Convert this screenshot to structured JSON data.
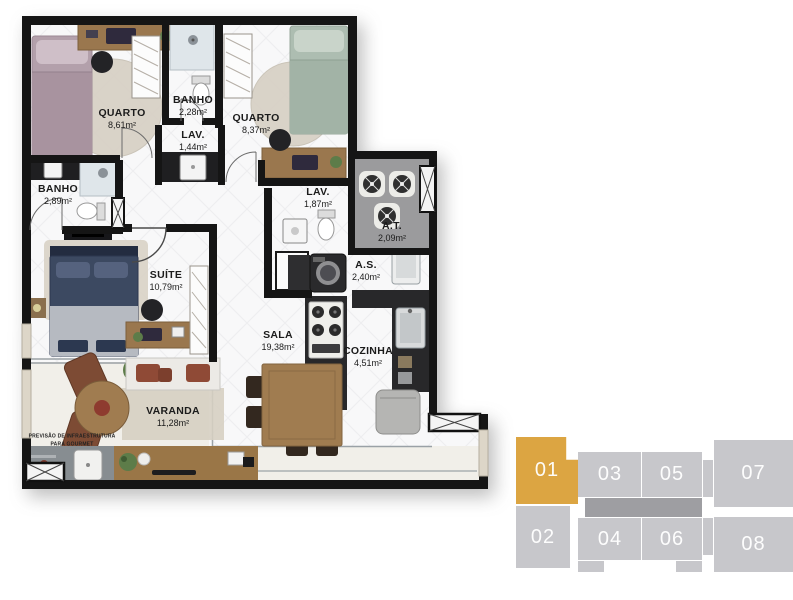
{
  "plan": {
    "rooms": [
      {
        "name": "QUARTO",
        "area": "8,61m²"
      },
      {
        "name": "BANHO",
        "area": "2,28m²"
      },
      {
        "name": "LAV.",
        "area": "1,44m²"
      },
      {
        "name": "QUARTO",
        "area": "8,37m²"
      },
      {
        "name": "BANHO",
        "area": "2,89m²"
      },
      {
        "name": "LAV.",
        "area": "1,87m²"
      },
      {
        "name": "A.T.",
        "area": "2,09m²"
      },
      {
        "name": "SUÍTE",
        "area": "10,79m²"
      },
      {
        "name": "A.S.",
        "area": "2,40m²"
      },
      {
        "name": "SALA",
        "area": "19,38m²"
      },
      {
        "name": "COZINHA",
        "area": "4,51m²"
      },
      {
        "name": "VARANDA",
        "area": "11,28m²"
      }
    ],
    "gourmet_note": {
      "line1": "PREVISÃO DE INFRAESTRUTURA",
      "line2": "PARA GOURMET"
    }
  },
  "unit_map": {
    "units": [
      {
        "label": "01",
        "highlighted": true
      },
      {
        "label": "02",
        "highlighted": false
      },
      {
        "label": "03",
        "highlighted": false
      },
      {
        "label": "04",
        "highlighted": false
      },
      {
        "label": "05",
        "highlighted": false
      },
      {
        "label": "06",
        "highlighted": false
      },
      {
        "label": "07",
        "highlighted": false
      },
      {
        "label": "08",
        "highlighted": false
      }
    ],
    "colors": {
      "highlight": "#DCA542",
      "unit": "#C7C7CB",
      "corridor": "#9E9EA2",
      "label": "#FFFFFF"
    }
  }
}
